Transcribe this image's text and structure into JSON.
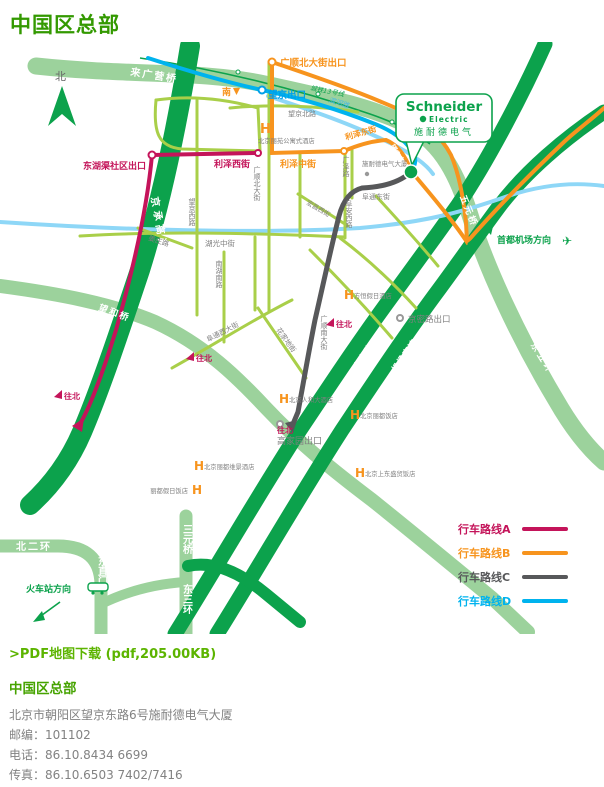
{
  "page": {
    "title": "中国区总部"
  },
  "map": {
    "compass": "北",
    "hotel_marker": "H",
    "callout": {
      "brand": "Schneider",
      "brand_sub": "Electric",
      "brand_cn": "施耐德电气"
    },
    "location": {
      "building": "施耐德电气大厦"
    },
    "icons": {
      "airplane": "✈"
    },
    "roads": {
      "laiguangying": "来广营桥",
      "jingcheng": "京承高速",
      "wanghe": "望和桥",
      "siyuan": "四元桥",
      "wuyuan": "五元桥",
      "dongwuhuan": "东五环",
      "beierhuan": "北二环",
      "dongzhimen": "东直门",
      "sanyuanqiao": "三元桥",
      "dongsanhuan": "东三环",
      "jingmi": "京密路",
      "jichang": "机场高速",
      "wangjingbei": "望京北路",
      "guangshunbei": "广顺北大街",
      "wangjingxi": "望京西路",
      "huguangzhong": "湖光中街",
      "jiangzhuang": "姜庄路",
      "nanhunan": "南湖南路",
      "fuanxi": "阜安西路",
      "guangshunnan": "广顺南大街",
      "futongxi": "阜通西大街",
      "huajiadi": "花家地街",
      "guangze": "广泽路",
      "futongdong": "阜通东街",
      "wangjingdong": "望京东路",
      "lizexi": "利泽西街",
      "lizezhong": "利泽中街",
      "lizedong": "利泽东街",
      "hongchang": "宏昌西街",
      "binhe": "滨河路",
      "chengtie": "城铁13号线"
    },
    "exits": {
      "guangshun": "广顺北大街出口",
      "wangjing": "望京出口",
      "donghuqu": "东湖渠社区出口",
      "jingmilu": "京密路出口",
      "gaojiayuan": "高家园出口"
    },
    "directions": {
      "airport": "首都机场方向",
      "railway": "火车站方向",
      "south": "南",
      "wangbei": "往北"
    },
    "hotels": [
      {
        "name": "北京丽苑公寓式酒店"
      },
      {
        "name": "方恒假日酒店"
      },
      {
        "name": "北京人和大酒店"
      },
      {
        "name": "北京丽都饭店"
      },
      {
        "name": "北京丽都维景酒店"
      },
      {
        "name": "丽都假日饭店"
      },
      {
        "name": "北京上东盛贸饭店"
      }
    ],
    "legend": [
      {
        "label": "行车路线A",
        "color": "#c4145a"
      },
      {
        "label": "行车路线B",
        "color": "#f7941e"
      },
      {
        "label": "行车路线C",
        "color": "#57585a"
      },
      {
        "label": "行车路线D",
        "color": "#00b3ee"
      }
    ]
  },
  "download": {
    "label": ">PDF地图下载 (pdf,205.00KB)"
  },
  "contact": {
    "heading": "中国区总部",
    "lines": [
      "北京市朝阳区望京东路6号施耐德电气大厦",
      "邮编：101102",
      "电话：86.10.8434 6699",
      "传真：86.10.6503 7402/7416"
    ]
  }
}
